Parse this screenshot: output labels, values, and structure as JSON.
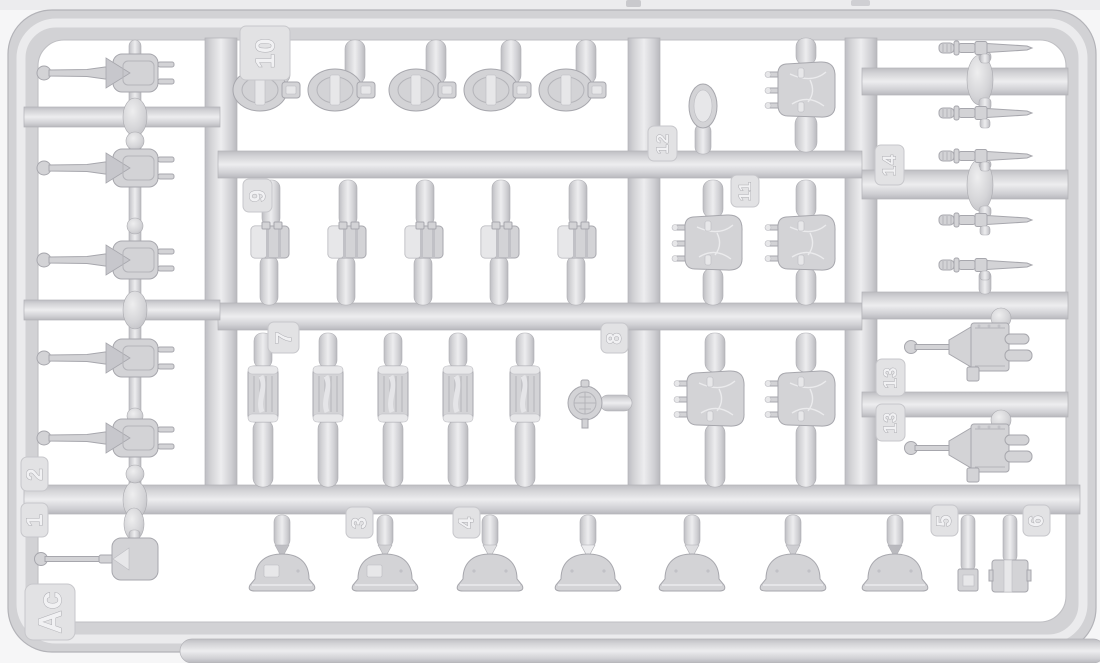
{
  "description": "Photo of a light-gray injection-molded styrene sprue (plastic model kit parts frame) with numbered part gates",
  "colors": {
    "plastic": "#d3d3d6",
    "plastic_highlight": "#ededef",
    "plastic_shadow": "#b7b7bc",
    "background": "#f6f6f7",
    "section_background": "#ffffff",
    "tag_plate": "#e2e2e4"
  },
  "tags": {
    "t1": "1",
    "t2": "2",
    "t3": "3",
    "t4": "4",
    "t5": "5",
    "t6": "6",
    "t7": "7",
    "t8": "8",
    "t9": "9",
    "t10": "10",
    "t11": "11",
    "t12": "12",
    "t13a": "13",
    "t13b": "13",
    "t14": "14",
    "ac": "Ac"
  },
  "parts_inventory": [
    {
      "tag": "1",
      "part": "entrenching-shovel",
      "count": 1
    },
    {
      "tag": "2",
      "part": "gun-with-mount",
      "count": 5
    },
    {
      "tag": "3",
      "part": "stahlhelm-helmet-with-side-plate",
      "count": 2
    },
    {
      "tag": "4",
      "part": "stahlhelm-helmet",
      "count": 5
    },
    {
      "tag": "5",
      "part": "small-square-box",
      "count": 1
    },
    {
      "tag": "6",
      "part": "round-drum-canister",
      "count": 1
    },
    {
      "tag": "7",
      "part": "fluted-gas-mask-canister",
      "count": 5
    },
    {
      "tag": "8",
      "part": "round-lid",
      "count": 1
    },
    {
      "tag": "9",
      "part": "bread-bag-pouch",
      "count": 5
    },
    {
      "tag": "10",
      "part": "oval-pouch",
      "count": 5
    },
    {
      "tag": "11",
      "part": "backpack",
      "count": 5
    },
    {
      "tag": "12",
      "part": "flat-oval-lid",
      "count": 1
    },
    {
      "tag": "13",
      "part": "machine-gun-with-mount",
      "count": 2
    },
    {
      "tag": "14",
      "part": "bayonet-with-scabbard",
      "count": 5
    },
    {
      "tag": "Ac",
      "part": "sprue-letter-code",
      "count": 1
    }
  ]
}
